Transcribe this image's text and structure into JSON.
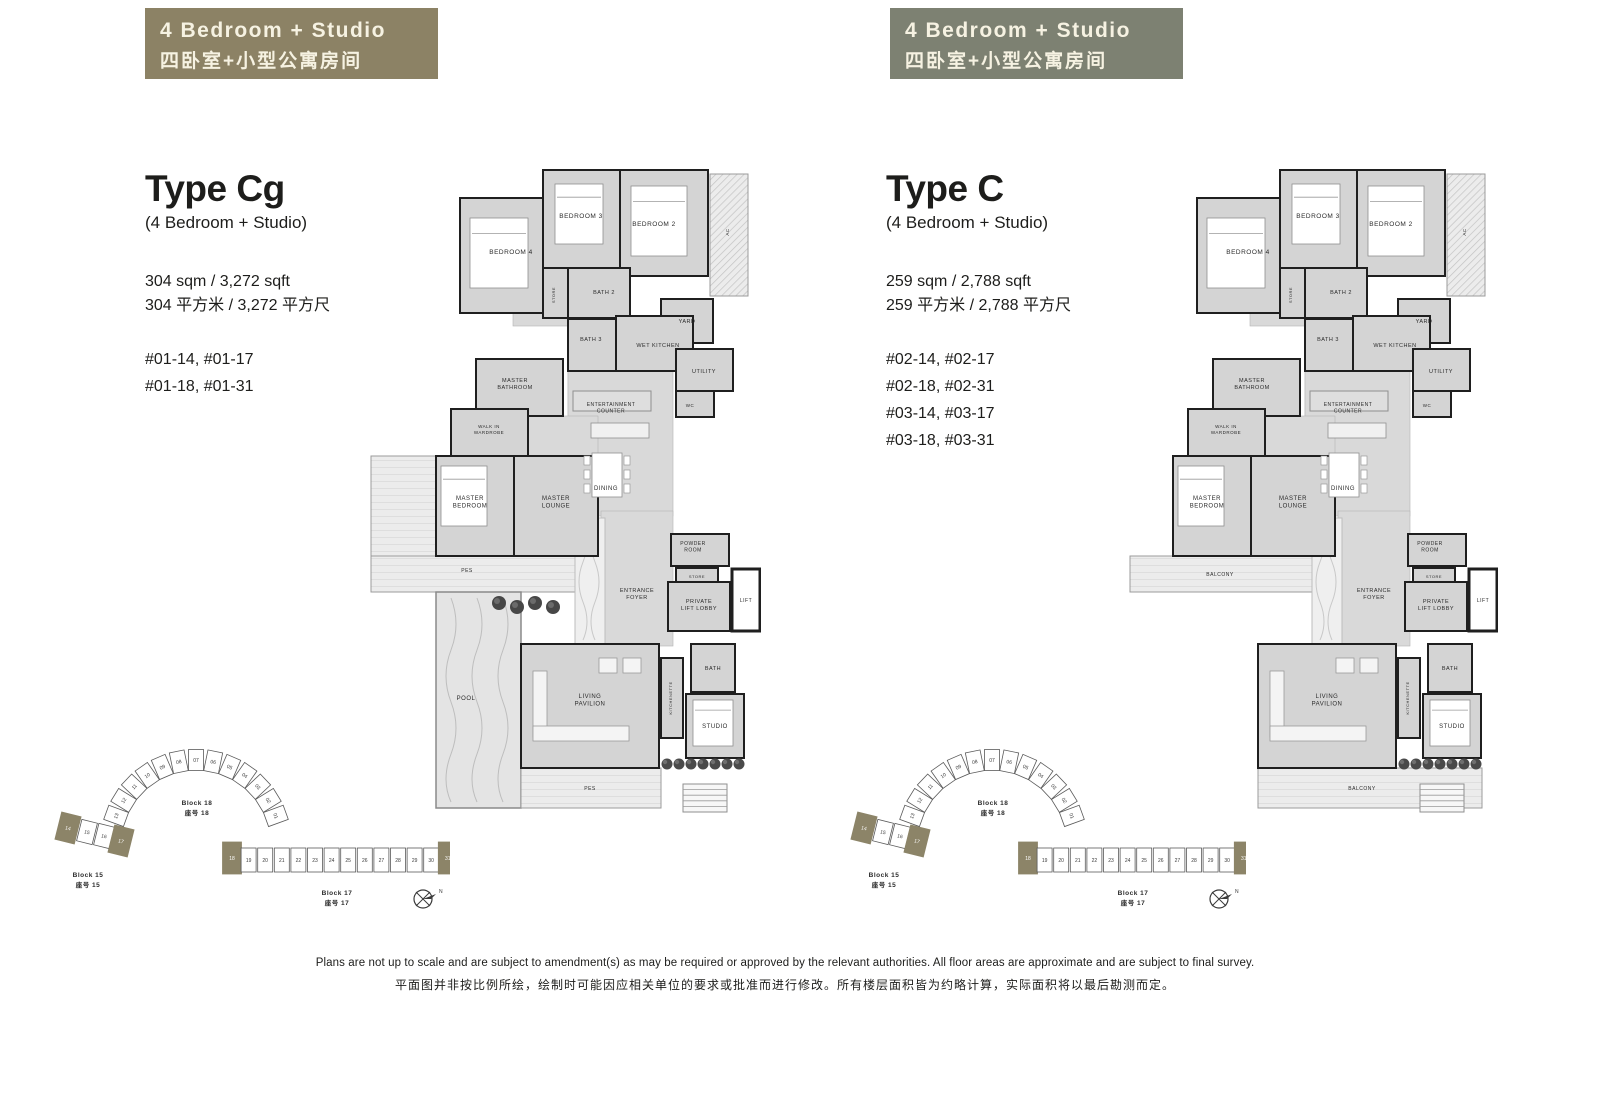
{
  "panels": [
    {
      "badge": {
        "title_en": "4 Bedroom +  Studio",
        "title_zh": "四卧室+小型公寓房间"
      },
      "type_title": "Type Cg",
      "type_subtitle": "(4 Bedroom + Studio)",
      "area_en": "304 sqm / 3,272 sqft",
      "area_zh": "304 平方米 / 3,272 平方尺",
      "units": [
        "#01-14, #01-17",
        "#01-18, #01-31"
      ],
      "outdoor": {
        "side": "PES",
        "bottom": "PES",
        "pool": "POOL"
      }
    },
    {
      "badge": {
        "title_en": "4 Bedroom +  Studio",
        "title_zh": "四卧室+小型公寓房间"
      },
      "type_title": "Type C",
      "type_subtitle": "(4 Bedroom + Studio)",
      "area_en": "259 sqm / 2,788 sqft",
      "area_zh": "259 平方米 / 2,788 平方尺",
      "units": [
        "#02-14, #02-17",
        "#02-18, #02-31",
        "#03-14, #03-17",
        "#03-18, #03-31"
      ],
      "outdoor": {
        "side": "BALCONY",
        "bottom": "BALCONY",
        "pool": null
      }
    }
  ],
  "room_labels": {
    "bedroom4": "BEDROOM 4",
    "bedroom3": "BEDROOM 3",
    "bedroom2": "BEDROOM 2",
    "bath2": "BATH 2",
    "bath3": "BATH 3",
    "store": "STORE",
    "store2": "STORE",
    "yard": "YARD",
    "wet_kitchen": "WET KITCHEN",
    "utility": "UTILITY",
    "wc": "WC",
    "master_bathroom": "MASTER BATHROOM",
    "walk_in_wardrobe": "WALK IN WARDROBE",
    "master_bedroom": "MASTER BEDROOM",
    "master_lounge": "MASTER LOUNGE",
    "dining": "DINING",
    "entertainment_counter": "ENTERTAINMENT COUNTER",
    "powder_room": "POWDER ROOM",
    "entrance_foyer": "ENTRANCE FOYER",
    "private_lift_lobby": "PRIVATE LIFT LOBBY",
    "lift": "LIFT",
    "kitchenette": "KITCHENETTE",
    "bath": "BATH",
    "studio": "STUDIO",
    "living_pavilion": "LIVING PAVILION",
    "ac": "AC"
  },
  "keyplan": {
    "arc_block": {
      "name_en": "Block 18",
      "name_zh": "座号 18",
      "units": [
        "01",
        "02",
        "03",
        "04",
        "05",
        "06",
        "07",
        "08",
        "09",
        "10",
        "11",
        "12",
        "13"
      ],
      "highlighted": []
    },
    "cluster_block": {
      "name_en": "Block 15",
      "name_zh": "座号 15",
      "units": [
        "14",
        "15",
        "16",
        "17"
      ],
      "highlighted": [
        "14",
        "17"
      ]
    },
    "row_block": {
      "name_en": "Block 17",
      "name_zh": "座号 17",
      "units": [
        "18",
        "19",
        "20",
        "21",
        "22",
        "23",
        "24",
        "25",
        "26",
        "27",
        "28",
        "29",
        "30",
        "31"
      ],
      "highlighted": [
        "18",
        "31"
      ]
    },
    "compass_label": "N"
  },
  "disclaimer": {
    "en": "Plans are not up to scale and are subject to amendment(s) as may be required or approved by the relevant authorities. All floor areas are approximate and are subject to final survey.",
    "zh": "平面图并非按比例所绘，绘制时可能因应相关单位的要求或批准而进行修改。所有楼层面积皆为约略计算，实际面积将以最后勘测而定。"
  },
  "colors": {
    "badge_left": "#8c8265",
    "badge_right": "#7d8172",
    "highlight": "#8c8468",
    "wall": "#1f1f1f",
    "room_fill": "#d4d4d4",
    "open_fill": "#d9d9d9",
    "outdoor_fill": "#ececec",
    "pool_fill": "#e4e4e4",
    "label_text": "#2b2b2b"
  }
}
